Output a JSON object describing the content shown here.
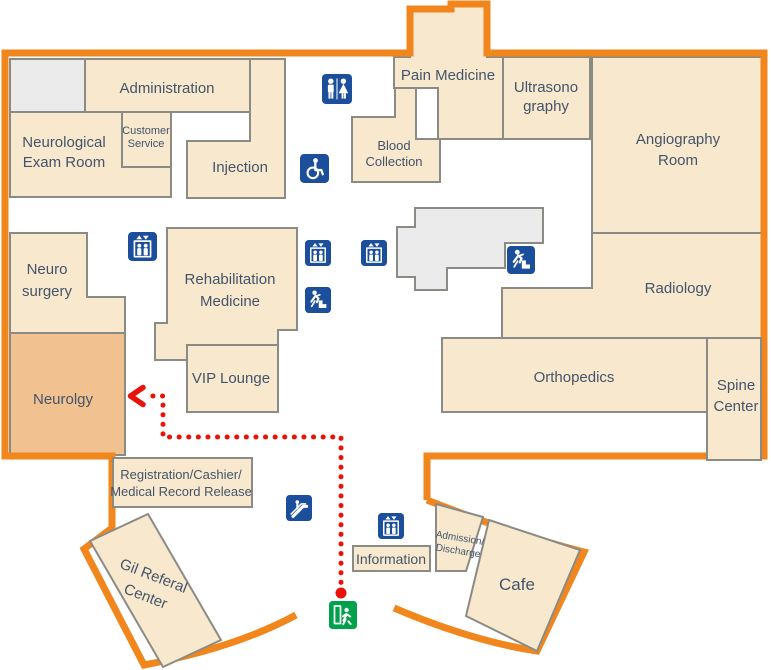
{
  "floorplan": {
    "highlighted_room": "Neurolgy",
    "route": {
      "destination": "Neurolgy",
      "style": "dotted"
    },
    "rooms": {
      "administration": {
        "label": "Administration"
      },
      "neurological_exam_room": {
        "lines": [
          "Neurological",
          "Exam Room"
        ]
      },
      "customer_service": {
        "lines": [
          "Customer",
          "Service"
        ]
      },
      "injection": {
        "label": "Injection"
      },
      "pain_medicine": {
        "label": "Pain Medicine"
      },
      "blood_collection": {
        "lines": [
          "Blood",
          "Collection"
        ]
      },
      "ultrasonography": {
        "lines": [
          "Ultrasono",
          "graphy"
        ]
      },
      "angiography_room": {
        "lines": [
          "Angiography",
          "Room"
        ]
      },
      "neuro_surgery": {
        "lines": [
          "Neuro",
          "surgery"
        ]
      },
      "rehabilitation_medicine": {
        "lines": [
          "Rehabilitation",
          "Medicine"
        ]
      },
      "vip_lounge": {
        "label": "VIP Lounge"
      },
      "radiology": {
        "label": "Radiology"
      },
      "orthopedics": {
        "label": "Orthopedics"
      },
      "spine_center": {
        "lines": [
          "Spine",
          "Center"
        ]
      },
      "neurology": {
        "label": "Neurolgy"
      },
      "registration": {
        "lines": [
          "Registration/Cashier/",
          "Medical Record Release"
        ]
      },
      "gil_referal_center": {
        "lines": [
          "Gil Referal",
          "Center"
        ]
      },
      "information": {
        "label": "Information"
      },
      "admission_discharge": {
        "lines": [
          "Admission/",
          "Discharge"
        ]
      },
      "cafe": {
        "label": "Cafe"
      }
    },
    "icons": {
      "restroom": "restroom",
      "wheelchair": "wheelchair-accessible",
      "elevator": "elevator",
      "emergency_stairs": "emergency-stairs",
      "escalator": "escalator",
      "emergency_exit": "emergency-exit"
    },
    "colors": {
      "outline_orange": "#F1861D",
      "room_fill": "#F7E8CE",
      "room_highlight": "#F1C290",
      "room_border": "#8B8B85",
      "unlabeled_fill": "#EBEBEB",
      "icon_blue": "#1B4E9B",
      "route_red": "#E91309",
      "exit_green": "#00A14B",
      "label_text": "#44546A"
    }
  }
}
